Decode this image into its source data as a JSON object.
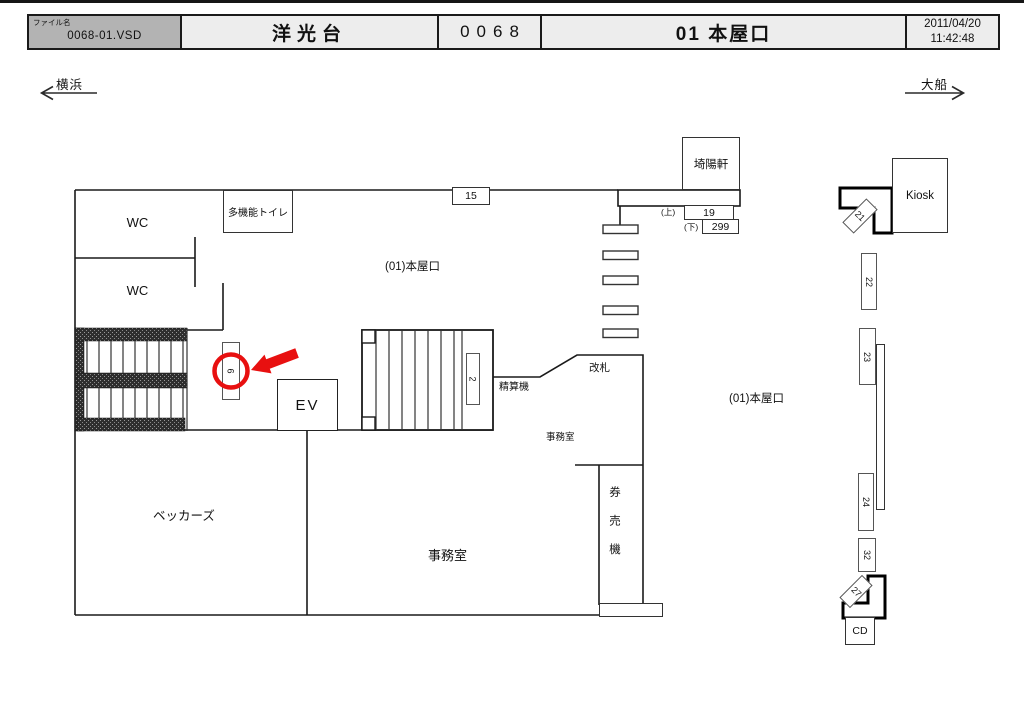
{
  "header": {
    "file_label": "ファイル名",
    "file_name": "0068-01.VSD",
    "station": "洋光台",
    "number": "0068",
    "gate_title": "01 本屋口",
    "date": "2011/04/20",
    "time": "11:42:48"
  },
  "nav": {
    "left_station": "横浜",
    "right_station": "大船"
  },
  "plan": {
    "rooms": {
      "wc": "WC",
      "multi_toilet": "多機能トイレ",
      "kiyoken": "埼陽軒",
      "kiosk": "Kiosk",
      "ev": "EV",
      "seisanki": "精算機",
      "kaisatsu": "改札",
      "jimushitsu": "事務室",
      "kenbaiki": "券売機",
      "beckers": "ベッカーズ",
      "cd": "CD",
      "honyaguchi": "(01)本屋口"
    },
    "annotations": {
      "up": "(上)",
      "down": "(下)"
    },
    "signs": {
      "s15": "15",
      "s19": "19",
      "s299": "299",
      "s6": "6",
      "s2": "2",
      "s21": "21",
      "s22": "22",
      "s23": "23",
      "s24": "24",
      "s32": "32",
      "s27": "27"
    }
  },
  "colors": {
    "highlight_red": "#e81010",
    "wall": "#1a1a1a",
    "header_file_bg": "#b3b3b3",
    "header_cell_bg": "#ededed"
  }
}
